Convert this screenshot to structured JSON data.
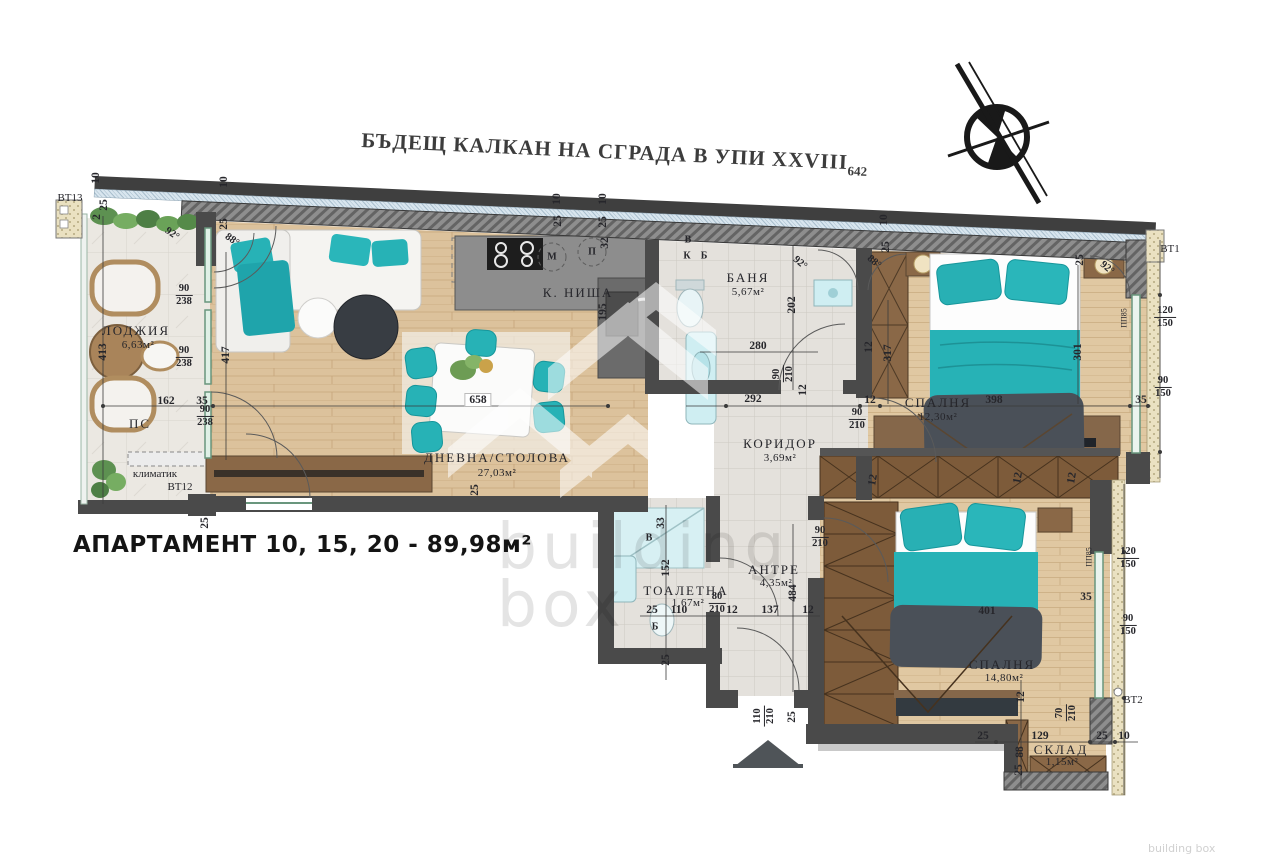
{
  "title": {
    "text": "БЪДЕЩ КАЛКАН НА СГРАДА В УПИ XXVIII",
    "subscript": "642"
  },
  "apartment_label": "АПАРТАМЕНТ 10, 15, 20 - 89,98м²",
  "watermark": {
    "line1": "building",
    "line2": "box",
    "corner": "building box"
  },
  "rooms": [
    {
      "name": "ЛОДЖИЯ",
      "area": "6,63м²"
    },
    {
      "name": "ДНЕВНА/СТОЛОВА",
      "area": "27,03м²"
    },
    {
      "name": "К. НИША",
      "area": ""
    },
    {
      "name": "БАНЯ",
      "area": "5,67м²"
    },
    {
      "name": "КОРИДОР",
      "area": "3,69м²"
    },
    {
      "name": "СПАЛНЯ",
      "area": "12,30м²"
    },
    {
      "name": "АНТРЕ",
      "area": "4,35м²"
    },
    {
      "name": "ТОАЛЕТНА",
      "area": "1,67м²"
    },
    {
      "name": "СПАЛНЯ",
      "area": "14,80м²"
    },
    {
      "name": "СКЛАД",
      "area": "1,15м²"
    }
  ],
  "colors": {
    "teal": "#27b2b6",
    "wood_floor": "#dcc29c",
    "wood_furniture": "#8a6847",
    "wall": "#4a4a4a",
    "tile": "#e4e1dc",
    "window_green": "#69967d",
    "watermark_gray": "#d2d2d2",
    "blanket_dark": "#4a5058"
  },
  "plan": {
    "labels": [
      {
        "t": "10",
        "x": 96,
        "y": 178,
        "r": -90
      },
      {
        "t": "25",
        "x": 104,
        "y": 205,
        "r": -90
      },
      {
        "t": "2",
        "x": 97,
        "y": 217,
        "r": -90
      },
      {
        "t": "10",
        "x": 224,
        "y": 182,
        "r": -90
      },
      {
        "t": "25",
        "x": 224,
        "y": 224,
        "r": -90
      },
      {
        "t": "92°",
        "x": 172,
        "y": 234,
        "r": 35,
        "k": "angle"
      },
      {
        "t": "88°",
        "x": 232,
        "y": 240,
        "r": 35,
        "k": "angle"
      },
      {
        "t": "413",
        "x": 103,
        "y": 352,
        "r": -90
      },
      {
        "f": [
          "90",
          "238"
        ],
        "x": 184,
        "y": 295
      },
      {
        "f": [
          "90",
          "238"
        ],
        "x": 184,
        "y": 357
      },
      {
        "f": [
          "90",
          "238"
        ],
        "x": 205,
        "y": 416
      },
      {
        "t": "162",
        "x": 166,
        "y": 401
      },
      {
        "t": "35",
        "x": 202,
        "y": 401
      },
      {
        "t": "417",
        "x": 226,
        "y": 355,
        "r": -90
      },
      {
        "t": "ЛОДЖИЯ",
        "x": 136,
        "y": 331,
        "k": "room"
      },
      {
        "t": "6,63м²",
        "x": 138,
        "y": 345,
        "k": "area"
      },
      {
        "t": "ПС",
        "x": 140,
        "y": 424,
        "k": "room"
      },
      {
        "t": "климатик",
        "x": 155,
        "y": 474,
        "k": "marker"
      },
      {
        "t": "ВТ12",
        "x": 180,
        "y": 487,
        "k": "marker"
      },
      {
        "t": "ВТ13",
        "x": 70,
        "y": 198,
        "k": "marker"
      },
      {
        "t": "25",
        "x": 205,
        "y": 523,
        "r": -90
      },
      {
        "t": "ДНЕВНА/СТОЛОВА",
        "x": 497,
        "y": 458,
        "k": "room"
      },
      {
        "t": "27,03м²",
        "x": 497,
        "y": 473,
        "k": "area"
      },
      {
        "t": "658",
        "x": 478,
        "y": 400,
        "k": "dimbox"
      },
      {
        "t": "25",
        "x": 475,
        "y": 490,
        "r": -90
      },
      {
        "t": "К. НИША",
        "x": 578,
        "y": 293,
        "k": "room"
      },
      {
        "t": "10",
        "x": 557,
        "y": 199,
        "r": -90
      },
      {
        "t": "25",
        "x": 558,
        "y": 221,
        "r": -90
      },
      {
        "t": "10",
        "x": 603,
        "y": 199,
        "r": -90
      },
      {
        "t": "25",
        "x": 603,
        "y": 222,
        "r": -90
      },
      {
        "t": "32",
        "x": 605,
        "y": 243,
        "r": -90
      },
      {
        "t": "195",
        "x": 603,
        "y": 312,
        "r": -90
      },
      {
        "t": "М",
        "x": 552,
        "y": 257,
        "k": "appl"
      },
      {
        "t": "П",
        "x": 592,
        "y": 252,
        "k": "appl"
      },
      {
        "t": "В",
        "x": 688,
        "y": 240,
        "k": "appl"
      },
      {
        "t": "К",
        "x": 687,
        "y": 256,
        "k": "appl"
      },
      {
        "t": "Б",
        "x": 704,
        "y": 256,
        "k": "appl"
      },
      {
        "t": "БАНЯ",
        "x": 748,
        "y": 278,
        "k": "room"
      },
      {
        "t": "5,67м²",
        "x": 748,
        "y": 292,
        "k": "area"
      },
      {
        "t": "92°",
        "x": 800,
        "y": 263,
        "r": 40,
        "k": "angle"
      },
      {
        "t": "202",
        "x": 792,
        "y": 305,
        "r": -90
      },
      {
        "t": "280",
        "x": 758,
        "y": 346
      },
      {
        "t": "292",
        "x": 753,
        "y": 399
      },
      {
        "f": [
          "90",
          "210"
        ],
        "x": 783,
        "y": 374,
        "r": -90
      },
      {
        "t": "12",
        "x": 803,
        "y": 390,
        "r": -90
      },
      {
        "t": "КОРИДОР",
        "x": 780,
        "y": 444,
        "k": "room"
      },
      {
        "t": "3,69м²",
        "x": 780,
        "y": 458,
        "k": "area"
      },
      {
        "t": "12",
        "x": 870,
        "y": 400
      },
      {
        "f": [
          "90",
          "210"
        ],
        "x": 857,
        "y": 419
      },
      {
        "t": "10",
        "x": 884,
        "y": 220,
        "r": -90
      },
      {
        "t": "25",
        "x": 886,
        "y": 247,
        "r": -90
      },
      {
        "t": "88°",
        "x": 874,
        "y": 262,
        "r": 40,
        "k": "angle"
      },
      {
        "t": "12",
        "x": 869,
        "y": 347,
        "r": -90
      },
      {
        "t": "317",
        "x": 888,
        "y": 353,
        "r": -90
      },
      {
        "t": "СПАЛНЯ",
        "x": 938,
        "y": 403,
        "k": "room"
      },
      {
        "t": "12,30м²",
        "x": 938,
        "y": 417,
        "k": "area"
      },
      {
        "t": "398",
        "x": 994,
        "y": 400
      },
      {
        "t": "301",
        "x": 1078,
        "y": 352,
        "r": -90
      },
      {
        "t": "25",
        "x": 1080,
        "y": 260,
        "r": -90
      },
      {
        "t": "92°",
        "x": 1107,
        "y": 268,
        "r": 40,
        "k": "angle"
      },
      {
        "t": "ПП85",
        "x": 1124,
        "y": 318,
        "r": -90,
        "k": "tiny"
      },
      {
        "t": "ВТ1",
        "x": 1170,
        "y": 249,
        "k": "marker"
      },
      {
        "f": [
          "120",
          "150"
        ],
        "x": 1165,
        "y": 317
      },
      {
        "f": [
          "90",
          "150"
        ],
        "x": 1163,
        "y": 387
      },
      {
        "t": "35",
        "x": 1141,
        "y": 400
      },
      {
        "t": "В",
        "x": 649,
        "y": 538,
        "k": "appl"
      },
      {
        "t": "33",
        "x": 661,
        "y": 523,
        "r": -90
      },
      {
        "t": "152",
        "x": 666,
        "y": 568,
        "r": -90
      },
      {
        "t": "ТОАЛЕТНА",
        "x": 686,
        "y": 591,
        "k": "room"
      },
      {
        "t": "1,67м²",
        "x": 688,
        "y": 603,
        "k": "area"
      },
      {
        "t": "25",
        "x": 652,
        "y": 610
      },
      {
        "t": "110",
        "x": 679,
        "y": 610
      },
      {
        "f": [
          "80",
          "210"
        ],
        "x": 717,
        "y": 603
      },
      {
        "t": "Б",
        "x": 655,
        "y": 627,
        "k": "appl"
      },
      {
        "t": "25",
        "x": 666,
        "y": 660,
        "r": -90
      },
      {
        "t": "АНТРЕ",
        "x": 774,
        "y": 570,
        "k": "room"
      },
      {
        "t": "4,35м²",
        "x": 776,
        "y": 583,
        "k": "area"
      },
      {
        "t": "484",
        "x": 793,
        "y": 593,
        "r": -90
      },
      {
        "t": "12",
        "x": 732,
        "y": 610
      },
      {
        "t": "137",
        "x": 770,
        "y": 610
      },
      {
        "t": "12",
        "x": 808,
        "y": 610
      },
      {
        "f": [
          "90",
          "210"
        ],
        "x": 820,
        "y": 537
      },
      {
        "f": [
          "110",
          "210"
        ],
        "x": 764,
        "y": 716,
        "r": -90
      },
      {
        "t": "25",
        "x": 792,
        "y": 717,
        "r": -90
      },
      {
        "t": "СПАЛНЯ",
        "x": 1002,
        "y": 665,
        "k": "room"
      },
      {
        "t": "14,80м²",
        "x": 1004,
        "y": 678,
        "k": "area"
      },
      {
        "t": "401",
        "x": 987,
        "y": 611
      },
      {
        "t": "12",
        "x": 1021,
        "y": 697,
        "r": -90
      },
      {
        "f": [
          "70",
          "210"
        ],
        "x": 1066,
        "y": 713,
        "r": -90
      },
      {
        "t": "25",
        "x": 983,
        "y": 736
      },
      {
        "t": "129",
        "x": 1040,
        "y": 736
      },
      {
        "t": "25",
        "x": 1102,
        "y": 736
      },
      {
        "t": "10",
        "x": 1124,
        "y": 736
      },
      {
        "t": "88",
        "x": 1020,
        "y": 752,
        "r": -90
      },
      {
        "t": "25",
        "x": 1019,
        "y": 770,
        "r": -90
      },
      {
        "t": "СКЛАД",
        "x": 1061,
        "y": 750,
        "k": "room"
      },
      {
        "t": "1,15м²",
        "x": 1062,
        "y": 762,
        "k": "area"
      },
      {
        "t": "ВТ2",
        "x": 1133,
        "y": 700,
        "k": "marker"
      },
      {
        "t": "ПП85",
        "x": 1089,
        "y": 557,
        "r": -90,
        "k": "tiny"
      },
      {
        "f": [
          "120",
          "150"
        ],
        "x": 1128,
        "y": 558
      },
      {
        "t": "35",
        "x": 1086,
        "y": 597
      },
      {
        "f": [
          "90",
          "150"
        ],
        "x": 1128,
        "y": 625
      },
      {
        "t": "12",
        "x": 873,
        "y": 480,
        "r": -80
      },
      {
        "t": "12",
        "x": 1018,
        "y": 478,
        "r": -80
      },
      {
        "t": "12",
        "x": 1072,
        "y": 478,
        "r": -80
      }
    ]
  }
}
